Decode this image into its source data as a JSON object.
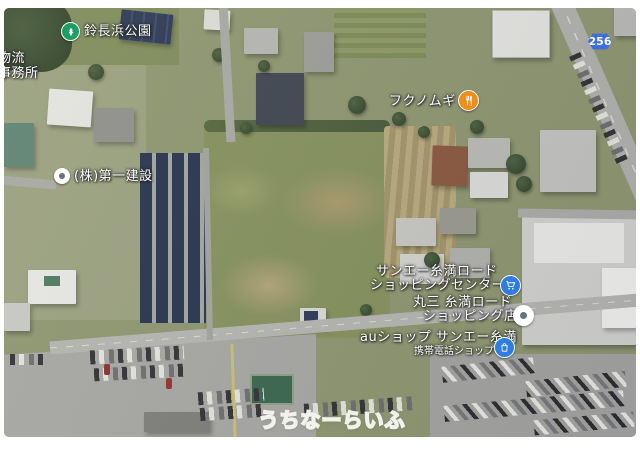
{
  "app": {
    "view": "satellite-map"
  },
  "pois": {
    "park": {
      "label": "鈴長浜公園",
      "icon": "park-tree-icon",
      "color": "#1e9e63"
    },
    "corner": {
      "line1": "物流",
      "line2": "事務所"
    },
    "daiichi": {
      "label": "(株)第一建設",
      "icon": "generic-place-icon"
    },
    "fukunomugi": {
      "label": "フクノムギ",
      "icon": "restaurant-icon",
      "color": "#ef8e1b"
    },
    "sanei": {
      "line1": "サンエー糸満ロード",
      "line2": "ショッピングセンター",
      "icon": "shopping-cart-icon",
      "color": "#2f7de1"
    },
    "marusan": {
      "line1": "丸三 糸満ロード",
      "line2": "ショッピング店",
      "icon": "generic-place-icon"
    },
    "aushop": {
      "line1": "auショップ サンエー糸満",
      "line2": "携帯電話ショップ",
      "icon": "shopping-bag-icon",
      "color": "#2f7de1"
    }
  },
  "roads": {
    "route_badge": "256",
    "badge_color": "#3d6edb"
  },
  "watermark": {
    "text": "うちなーらいふ"
  },
  "palette": {
    "label_text": "#ffffff",
    "park_green": "#1e9e63",
    "restaurant_orange": "#ef8e1b",
    "poi_blue": "#2f7de1",
    "route_badge_blue": "#3d6edb",
    "field_green": "#85905d",
    "road_gray": "#b4b4b0",
    "solar_panel_navy": "#28334e"
  }
}
